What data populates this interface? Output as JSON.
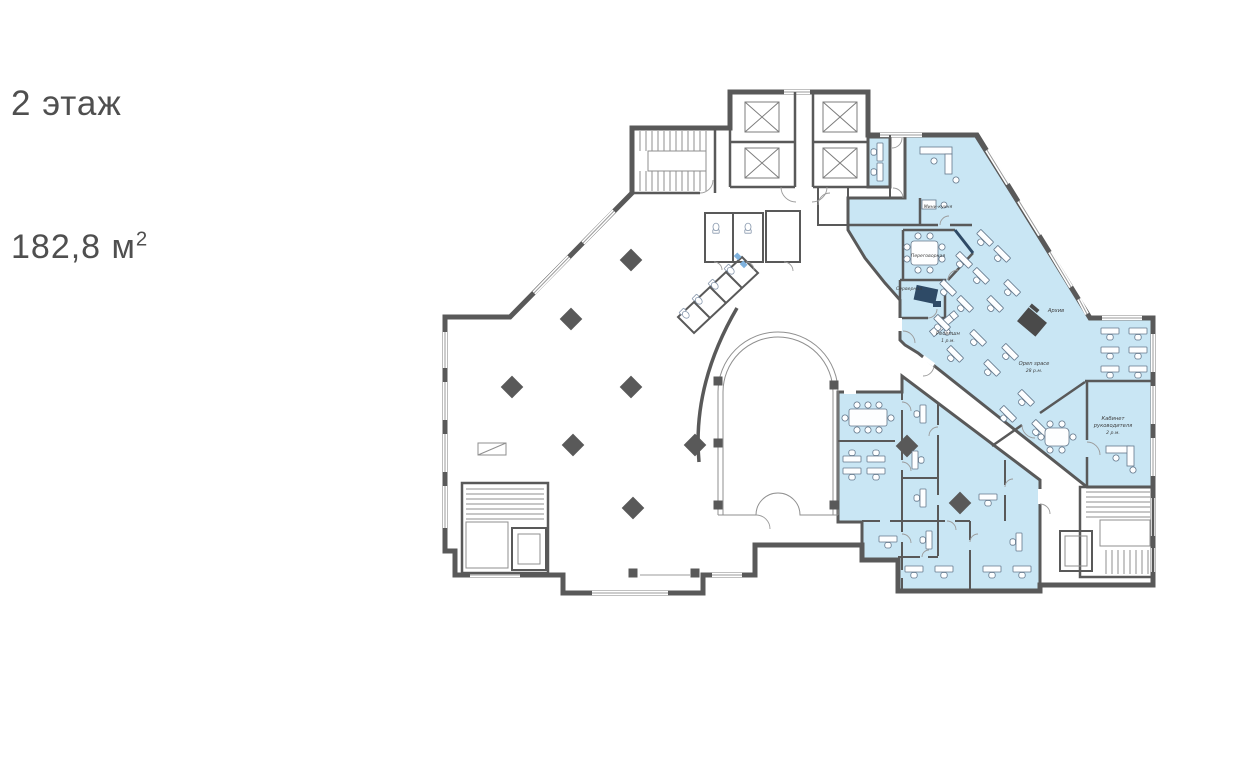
{
  "header": {
    "floor_label": "2 этаж",
    "area_label": "182,8 м",
    "area_superscript": "2"
  },
  "plan": {
    "labels": {
      "mini_kitchen": "Мини-кухня",
      "meeting_room": "Переговорная",
      "server_room": "Серверная",
      "reception_line1": "Ресепшн",
      "reception_line2": "1 р.м.",
      "archive": "Архив",
      "open_space_line1": "Open space",
      "open_space_line2": "28 р.м.",
      "director_line1": "Кабинет",
      "director_line2": "руководителя",
      "director_line3": "2 р.м."
    },
    "colors": {
      "highlight_fill": "#c9e6f4",
      "wall": "#595959",
      "accent_wall": "#2e4a66",
      "window": "#9b9b9b",
      "furniture_stroke": "#64788c",
      "label_text": "#3d3d3d",
      "title_text": "#4f4f4f"
    }
  }
}
